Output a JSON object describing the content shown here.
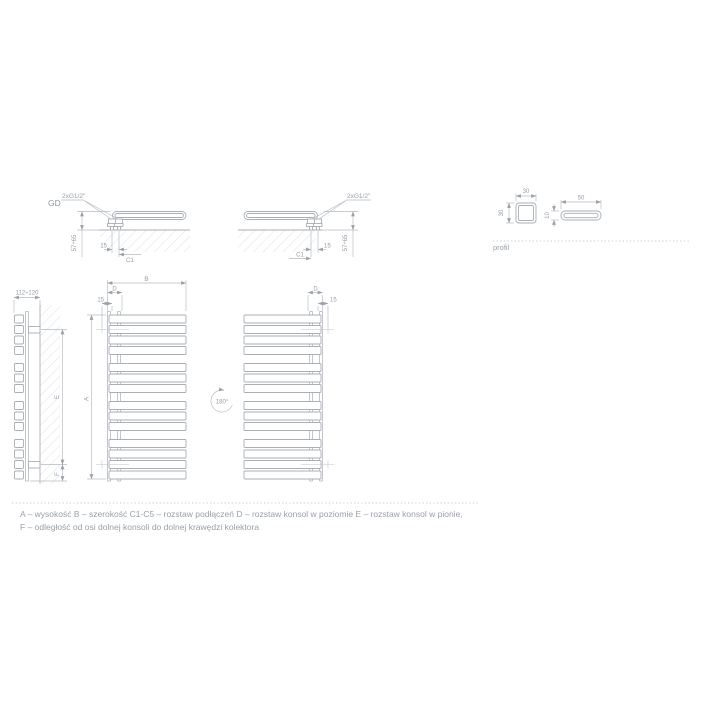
{
  "colors": {
    "background": "#ffffff",
    "object_line": "#a9afb5",
    "dimension_line": "#b4bac0",
    "text": "#959da5",
    "hatch": "#d6dade"
  },
  "labels": {
    "view_code": "GD",
    "connection": "2xG1/2\"",
    "profile_caption": "profil",
    "rotation": "180°"
  },
  "dims": {
    "depth_range": "57÷65",
    "fifteen": "15",
    "c1": "C1",
    "square_w": "30",
    "square_h": "30",
    "flat_w": "50",
    "flat_h": "10",
    "wall_distance": "112÷120",
    "a": "A",
    "b": "B",
    "d": "D",
    "e": "E",
    "f": "F"
  },
  "legend": {
    "line1": "A – wysokość B – szerokość C1-C5 – rozstaw podłączeń D – rozstaw konsol w poziomie E – rozstaw konsol w pionie,",
    "line2": "F – odległość od osi dolnej konsoli do dolnej krawędzi kolektora"
  }
}
